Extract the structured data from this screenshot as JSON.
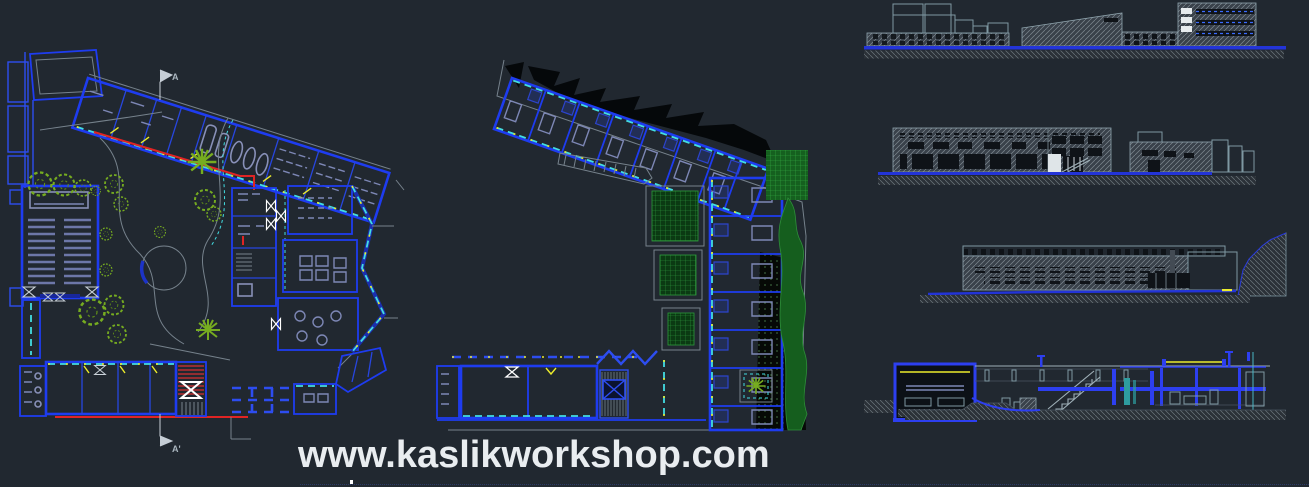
{
  "watermark": {
    "text": "www.kaslikworkshop.com",
    "color": "#e9edf0"
  },
  "markers": {
    "section_top": "A",
    "section_bottom": "A'"
  },
  "palette": {
    "background": "#212830",
    "wall_blue": "#1e3cf0",
    "glazing_cyan": "#43dde2",
    "accent_yellow": "#ecec2c",
    "accent_red": "#e02424",
    "tree_green": "#76ac20",
    "court_green": "#2e9a3c",
    "terrain_black": "#05080a",
    "furniture_lavender": "#7d87b5",
    "elevation_gray": "#8fa4ad",
    "ground_line_blue": "#2334d8",
    "watermark_text": "#e9edf0"
  }
}
